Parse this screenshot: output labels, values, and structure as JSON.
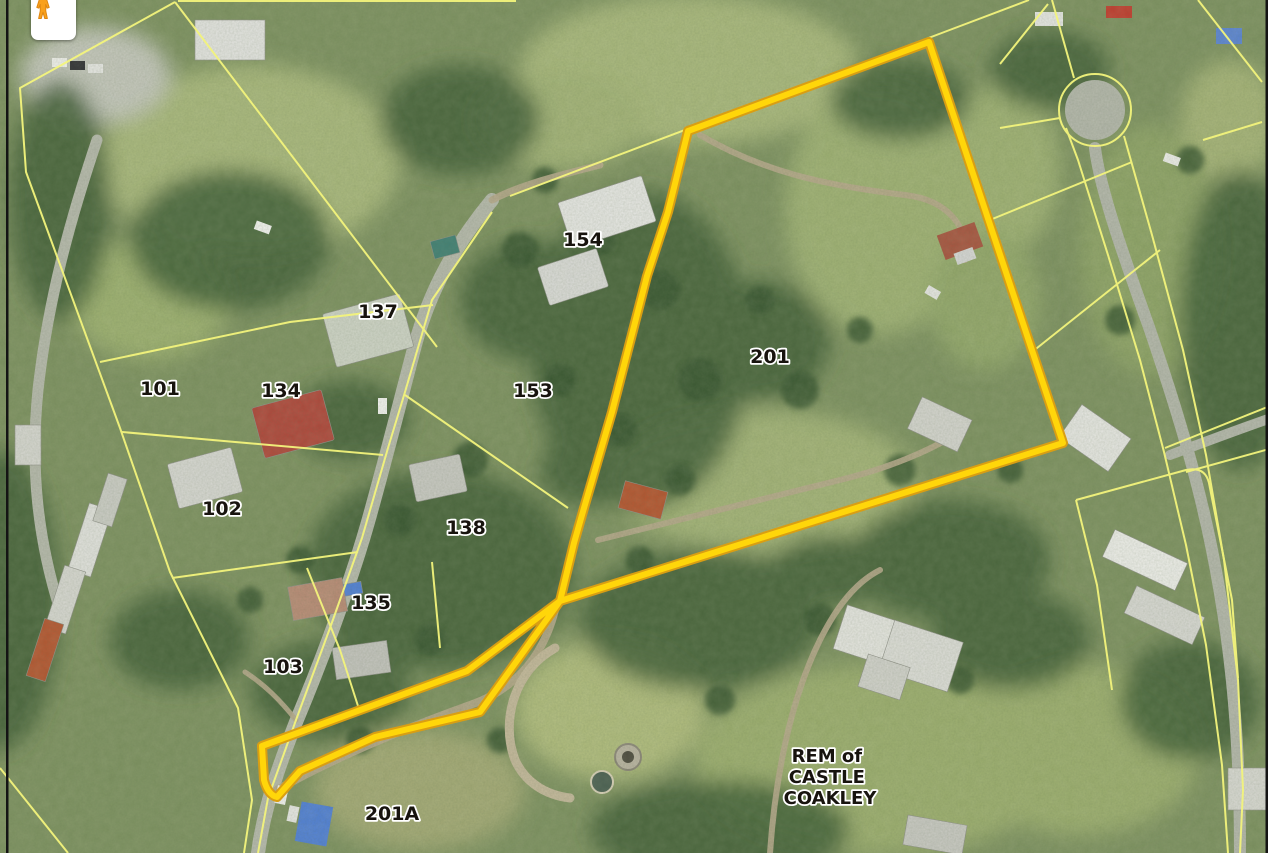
{
  "map": {
    "controls": {
      "pegman_icon": "street-view-pegman"
    },
    "colors": {
      "highlight": "#FFD60A",
      "highlight_edge": "#D99E13",
      "parcel_line": "#F3F47C",
      "label_fill": "#17130E",
      "label_halo": "#FFFFFF",
      "border": "#141414"
    },
    "parcel_labels": [
      {
        "text": "154"
      },
      {
        "text": "137"
      },
      {
        "text": "101"
      },
      {
        "text": "134"
      },
      {
        "text": "153"
      },
      {
        "text": "201"
      },
      {
        "text": "102"
      },
      {
        "text": "138"
      },
      {
        "text": "135"
      },
      {
        "text": "103"
      },
      {
        "text": "201A"
      }
    ],
    "area_label": {
      "lines": [
        "REM of",
        "CASTLE",
        "COAKLEY"
      ]
    }
  }
}
